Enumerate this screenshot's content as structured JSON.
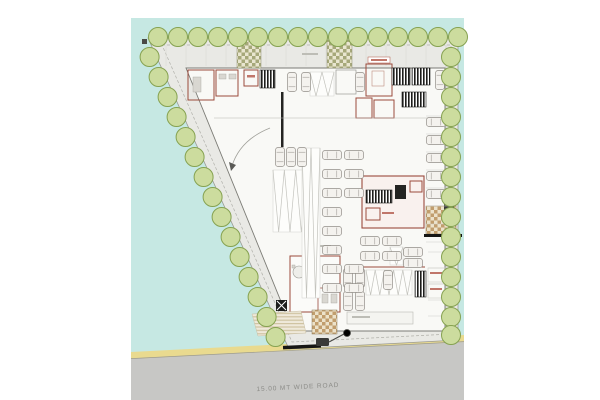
{
  "plan": {
    "road_label": "15.00 MT WIDE ROAD"
  },
  "colors": {
    "water": "#c6e8e3",
    "site": "#e9e9e5",
    "building": "#f9f9f6",
    "road": "#c7c7c5",
    "curb": "#e9da8f",
    "tree_fill": "#ccdc9e",
    "tree_stroke": "#86a251",
    "wall_red": "#9b4a3c",
    "detail_black": "#1d1d1b",
    "checker_olive": "#a6a87a",
    "checker_brown": "#c19e6e"
  },
  "features": {
    "water_area": "landscape water body",
    "tree_icon": "tree",
    "car_icon": "parked car",
    "staircase_icon": "staircase",
    "lift_icon": "lift",
    "gate_icon": "entrance gate",
    "barrier_icon": "boom barrier",
    "transformer_icon": "electrical box",
    "paver_icon": "checker paver plaza",
    "ramp_icon": "entry ramp"
  }
}
